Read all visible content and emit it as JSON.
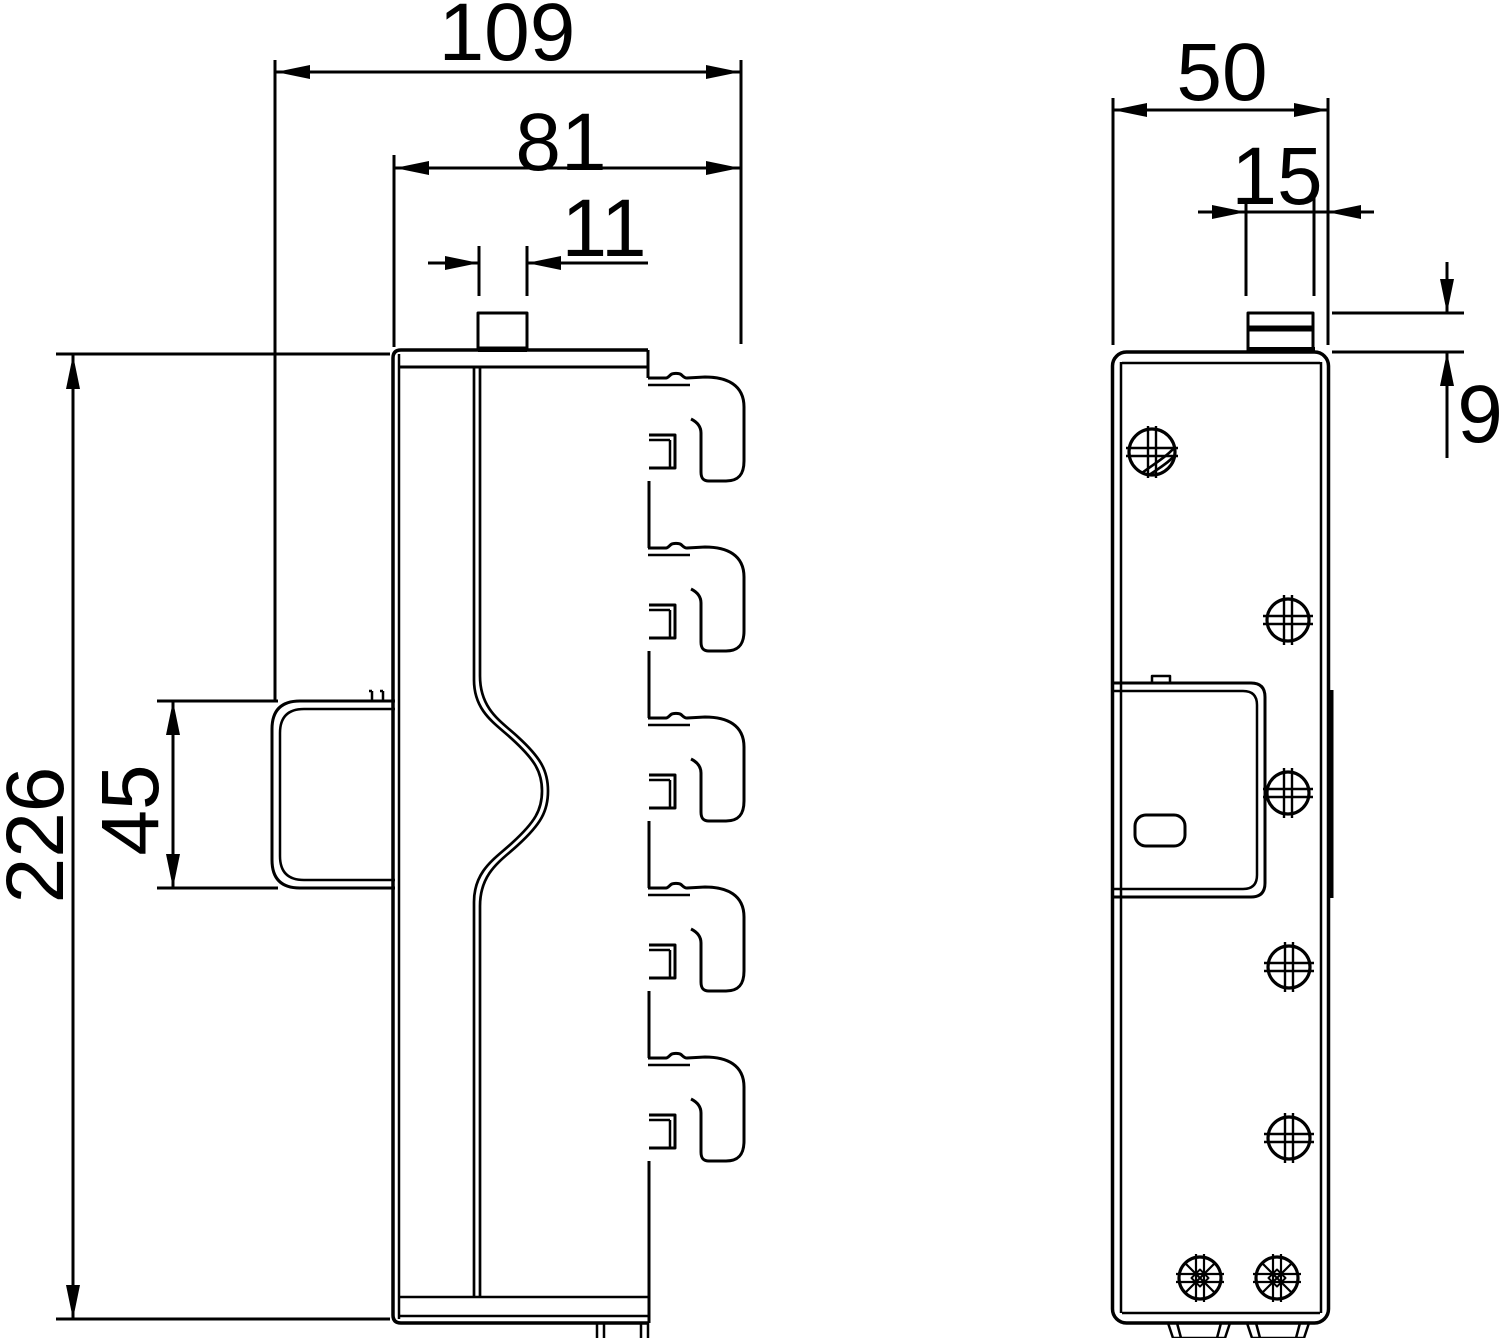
{
  "page": {
    "background": "#ffffff",
    "line_color": "#000000",
    "text_color": "#000000"
  },
  "drawing": {
    "type": "technical-dimension-drawing",
    "views": [
      {
        "id": "side-view",
        "name": "side profile view with mounting hooks and wall clip"
      },
      {
        "id": "front-view",
        "name": "front view with screws, latch box and feet"
      }
    ],
    "dimensions": {
      "overall_width": "109",
      "body_width": "81",
      "peg_width": "11",
      "overall_height": "226",
      "clip_height": "45",
      "front_width": "50",
      "tab_width": "15",
      "tab_height": "9"
    }
  }
}
